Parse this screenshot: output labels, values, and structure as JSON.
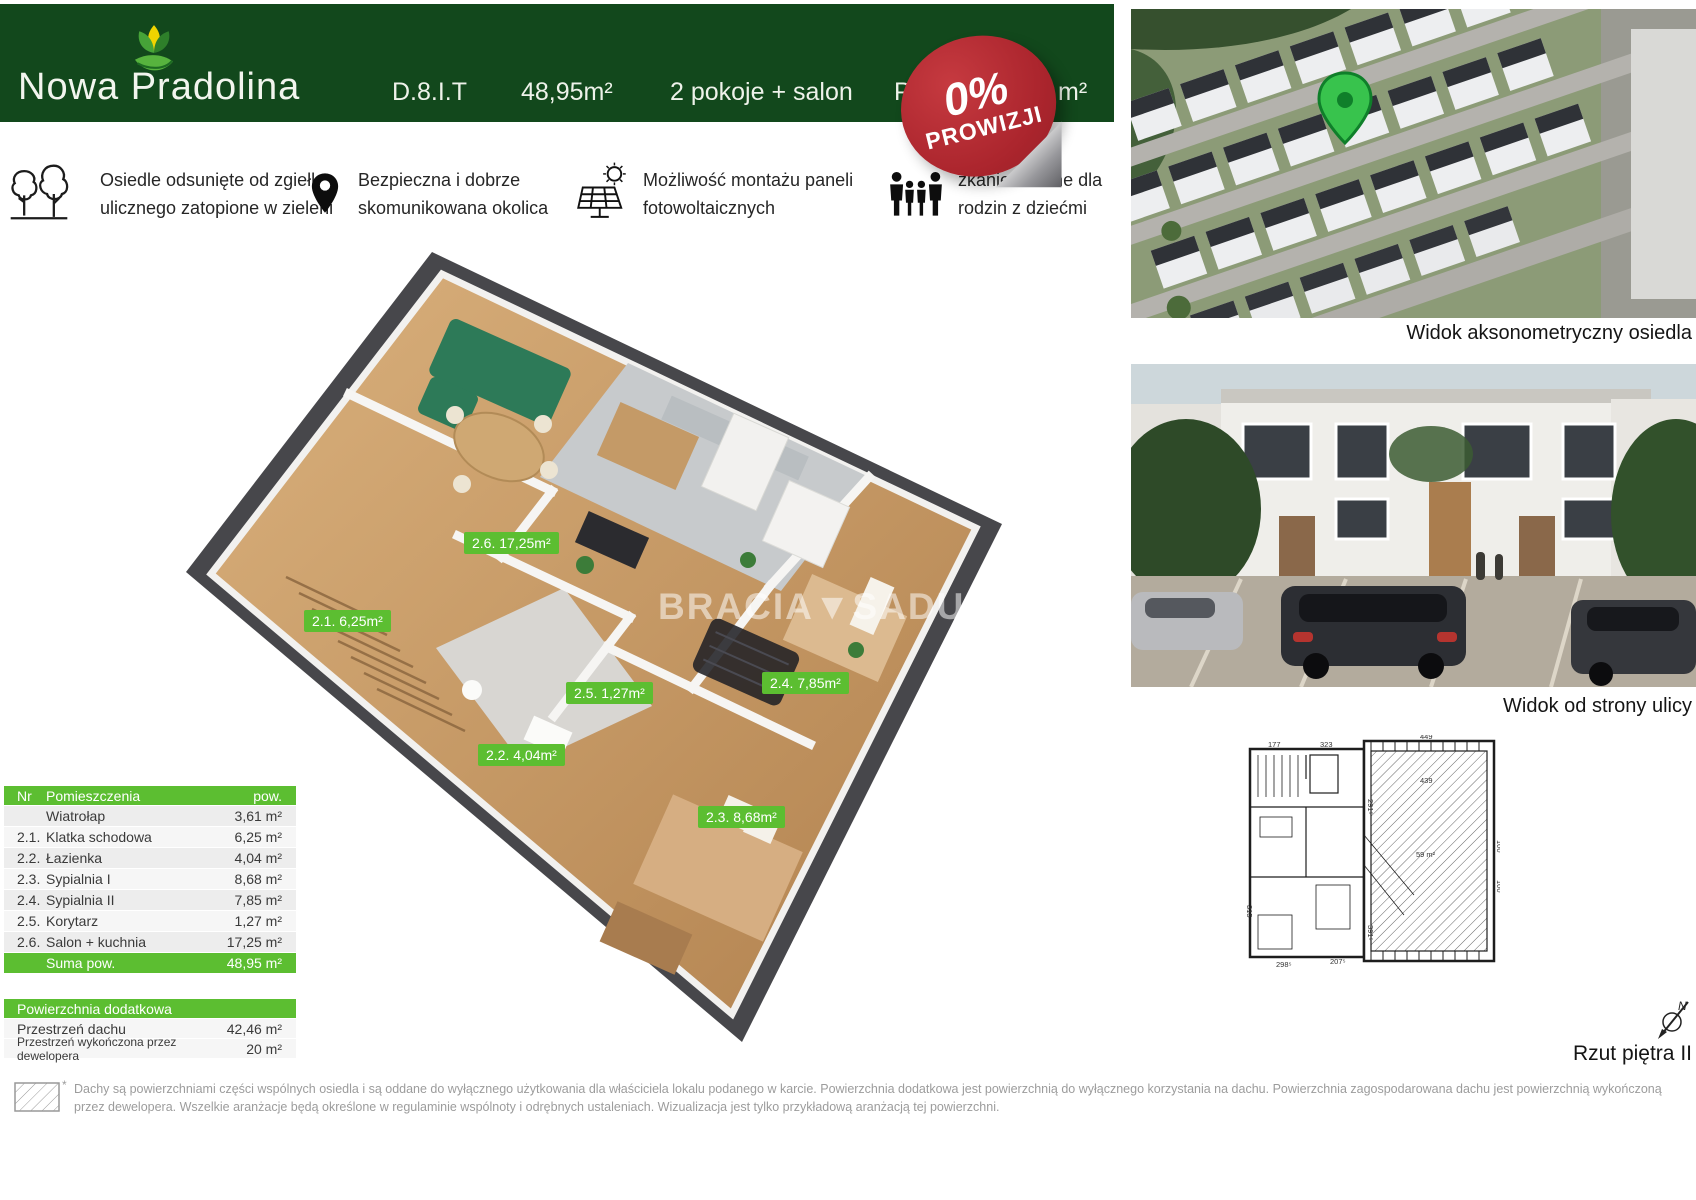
{
  "header": {
    "brand": "Nowa Pradolina",
    "unit": "D.8.I.T",
    "area": "48,95m²",
    "rooms": "2 pokoje + salon",
    "covered_left": "P",
    "covered_right": "m²"
  },
  "badge": {
    "percent": "0%",
    "word": "PROWIZJI"
  },
  "features": [
    {
      "icon": "trees-icon",
      "line1": "Osiedle odsunięte od zgiełku",
      "line2": "ulicznego zatopione w zieleni"
    },
    {
      "icon": "map-pin-icon",
      "line1": "Bezpieczna i dobrze",
      "line2": "skomunikowana okolica"
    },
    {
      "icon": "solar-panel-icon",
      "line1": "Możliwość montażu paneli",
      "line2": "fotowoltaicznych"
    },
    {
      "icon": "family-icon",
      "line1": "zkanie idealne dla",
      "line2": "rodzin z dziećmi"
    }
  ],
  "floor_plan": {
    "watermark": "BRACIA▼SADUR",
    "room_labels": [
      {
        "text": "2.6. 17,25m²"
      },
      {
        "text": "2.1. 6,25m²"
      },
      {
        "text": "2.5. 1,27m²"
      },
      {
        "text": "2.4. 7,85m²"
      },
      {
        "text": "2.2. 4,04m²"
      },
      {
        "text": "2.3. 8,68m²"
      }
    ]
  },
  "right_column": {
    "caption_top": "Widok aksonometryczny osiedla",
    "caption_middle": "Widok od strony ulicy",
    "caption_bottom": "Rzut piętra II",
    "compass": "N",
    "plan_dimensions": [
      "177",
      "323",
      "449",
      "439",
      "291⁵",
      "59 m²",
      "100",
      "100",
      "315",
      "298⁵",
      "207⁵",
      "391⁵"
    ]
  },
  "rooms_table": {
    "headers": {
      "nr": "Nr",
      "name": "Pomieszczenia",
      "area": "pow."
    },
    "rows": [
      {
        "nr": "",
        "name": "Wiatrołap",
        "area": "3,61 m²"
      },
      {
        "nr": "2.1.",
        "name": "Klatka schodowa",
        "area": "6,25 m²"
      },
      {
        "nr": "2.2.",
        "name": "Łazienka",
        "area": "4,04 m²"
      },
      {
        "nr": "2.3.",
        "name": "Sypialnia I",
        "area": "8,68 m²"
      },
      {
        "nr": "2.4.",
        "name": "Sypialnia II",
        "area": "7,85 m²"
      },
      {
        "nr": "2.5.",
        "name": "Korytarz",
        "area": "1,27 m²"
      },
      {
        "nr": "2.6.",
        "name": "Salon + kuchnia",
        "area": "17,25 m²"
      }
    ],
    "total": {
      "label": "Suma pow.",
      "area": "48,95 m²"
    }
  },
  "additional_table": {
    "header": "Powierzchnia dodatkowa",
    "rows": [
      {
        "name": "Przestrzeń dachu",
        "area": "42,46 m²"
      },
      {
        "name": "Przestrzeń wykończona przez dewelopera",
        "area": "20 m²"
      }
    ]
  },
  "footnote_mark": "*",
  "disclaimer": "Dachy są powierzchniami części wspólnych osiedla i są oddane do wyłącznego użytkowania dla właściciela lokalu podanego w karcie. Powierzchnia dodatkowa jest powierzchnią do wyłącznego korzystania na dachu. Powierzchnia zagospodarowana dachu jest powierzchnią wykończoną przez dewelopera. Wszelkie aranżacje będą określone w regulaminie wspólnoty i odrębnych ustaleniach. Wizualizacja jest tylko przykładową aranżacją tej powierzchni.",
  "colors": {
    "brand_green_dark": "#12481c",
    "accent_green": "#5cbe31",
    "badge_red": "#ab252d"
  }
}
